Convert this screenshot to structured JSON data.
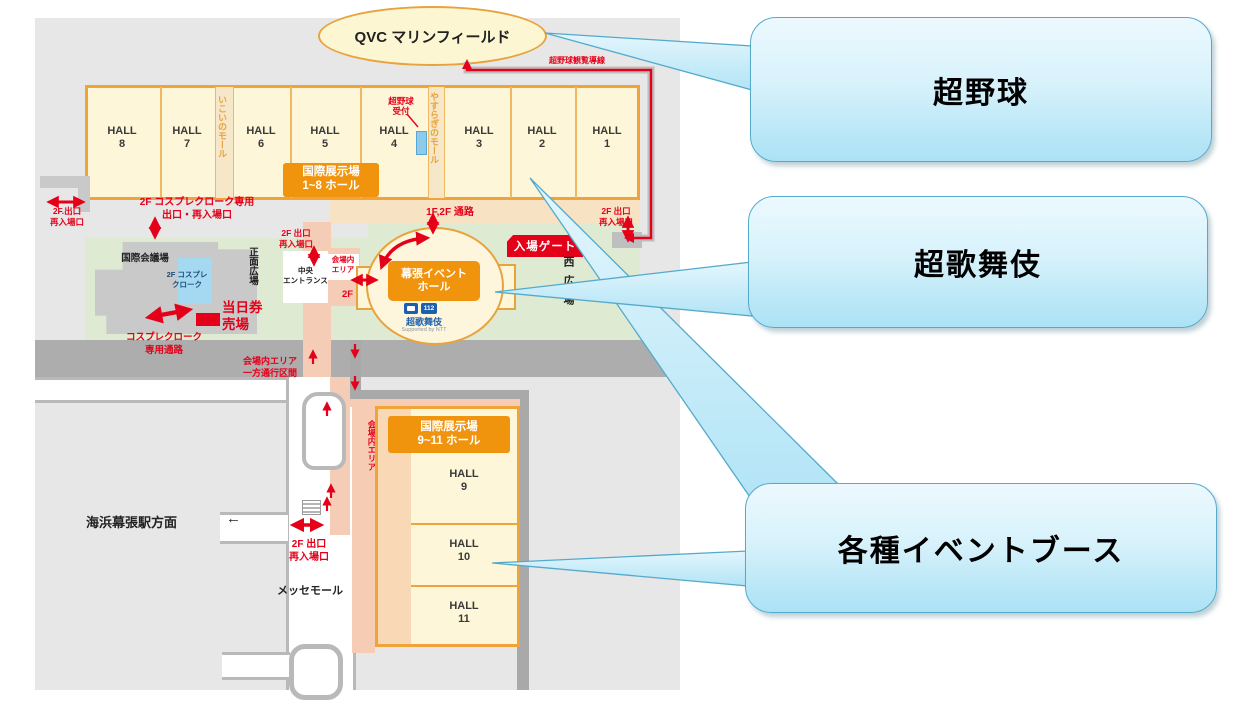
{
  "callouts": {
    "baseball": "超野球",
    "kabuki": "超歌舞伎",
    "booths": "各種イベントブース"
  },
  "map": {
    "stadium_label": "QVC マリンフィールド",
    "baseball_route": "超野球観覧導線",
    "baseball_reception": "超野球\n受付",
    "halls_1_8": [
      "HALL\n8",
      "HALL\n7",
      "HALL\n6",
      "HALL\n5",
      "HALL\n4",
      "HALL\n3",
      "HALL\n2",
      "HALL\n1"
    ],
    "mall_ikoi": "いこいのモール",
    "mall_yasuragi": "やすらぎのモール",
    "exhibition_1_8": "国際展示場\n1~8 ホール",
    "passage_1f2f": "1F,2F 通路",
    "exit_2f_left": "2F.出口\n再入場口",
    "cosplay_cloak_exit": "2F コスプレクローク専用\n出口・再入場口",
    "conference_center": "国際会議場",
    "cosplay_cloak_2f": "2F コスプレ\nクローク",
    "front_plaza": "正面広場",
    "exit_2f_center": "2F 出口\n再入場口",
    "central_entrance": "中央\nエントランス",
    "venue_area_box": "会場内\nエリア",
    "passage_2f": "2F 通路",
    "event_hall": "幕張イベント\nホール",
    "kabuki_logo_text": "超歌舞伎",
    "logo_112": "112",
    "ntt_credit": "Supported by NTT",
    "entrance_gate": "入場ゲート",
    "exit_2f_right": "2F 出口\n再入場口",
    "west_plaza": "西広場",
    "day_ticket": "当日券\n売場",
    "cosplay_passage": "コスプレクローク\n専用通路",
    "one_way": "会場内エリア\n一方通行区間",
    "venue_area_path": "会場内エリア",
    "station": "海浜幕張駅方面",
    "station_arrow": "←",
    "exit_2f_bottom": "2F 出口\n再入場口",
    "messe_mall": "メッセモール",
    "exhibition_9_11": "国際展示場\n9~11 ホール",
    "halls_9_11": [
      "HALL\n9",
      "HALL\n10",
      "HALL\n11"
    ]
  },
  "colors": {
    "callout_border": "#55aacb",
    "callout_fill_top": "#ecf9fe",
    "callout_fill_bottom": "#ace2f5",
    "map_red": "#e50019",
    "map_orange": "#f0930d",
    "hall_fill": "#fdf6d8",
    "green_area": "#deebd2",
    "pink_path": "#f5cdb6",
    "road_gray": "#adadad"
  }
}
